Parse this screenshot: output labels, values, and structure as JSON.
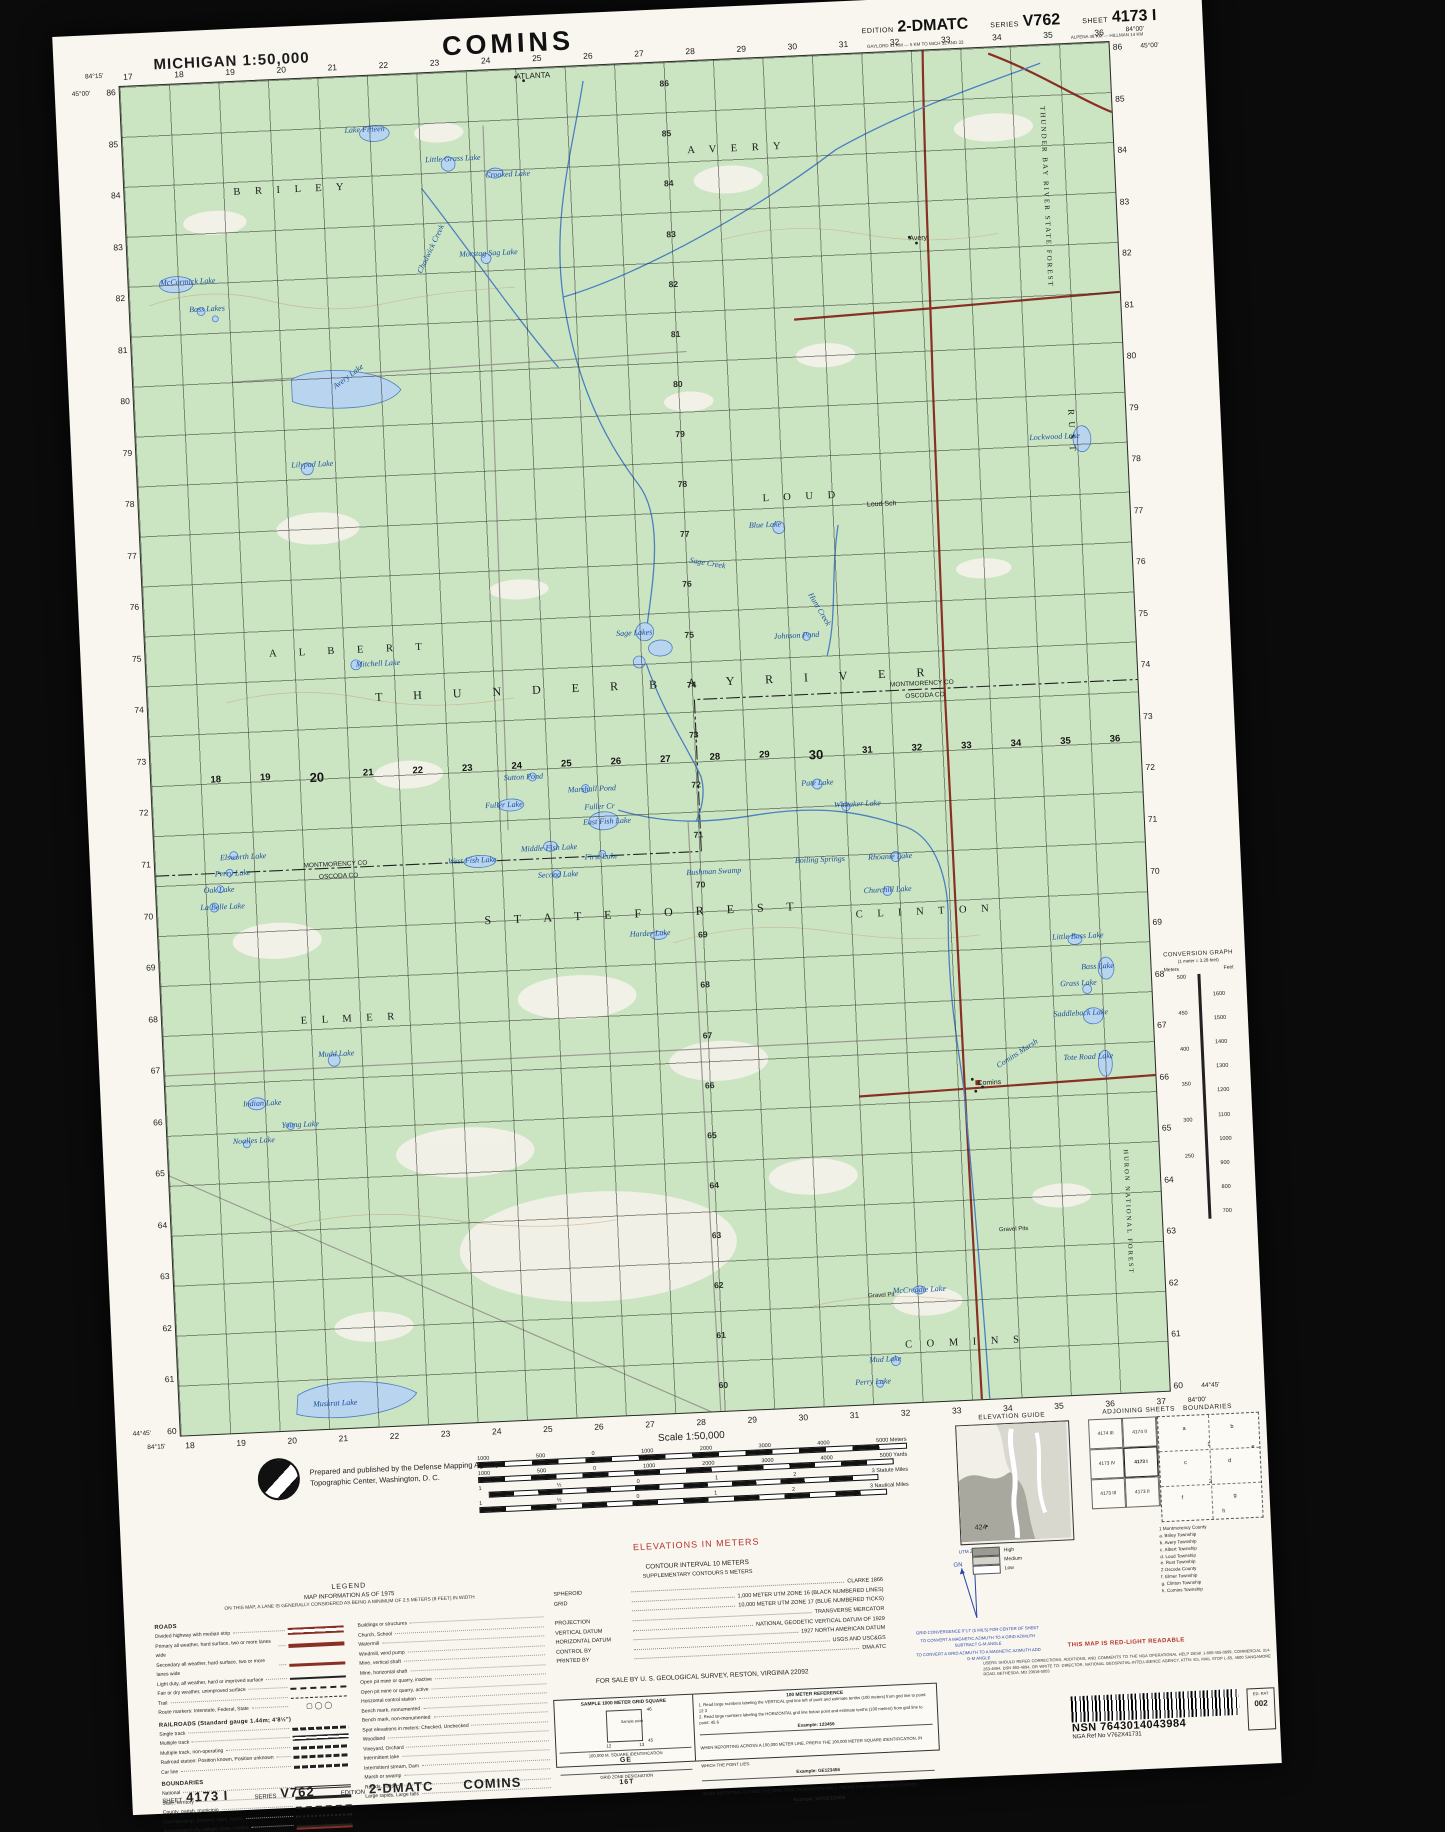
{
  "header": {
    "state_scale": "MICHIGAN 1:50,000",
    "title": "COMINS",
    "edition_label": "EDITION",
    "edition": "2-DMATC",
    "series_label": "SERIES",
    "series": "V762",
    "sheet_label": "SHEET",
    "sheet": "4173 I",
    "note1": "GAYLORD 41 KM — 5 KM TO MICH 32 AND 33",
    "note2": "ALPENA 48 KM — HILLMAN 14 KM"
  },
  "map": {
    "corners": {
      "tl_lon": "84°15'",
      "tr_lon": "84°00'",
      "tl_lat": "45°00'",
      "tr_lat": "45°00'",
      "bl_lat": "44°45'",
      "br_lat": "44°45'",
      "bl_lon": "84°15'",
      "br_lon": "84°00'"
    },
    "top_nums": [
      "17",
      "18",
      "19",
      "20",
      "21",
      "22",
      "23",
      "24",
      "25",
      "26",
      "27",
      "28",
      "29",
      "30",
      "31",
      "32",
      "33",
      "34",
      "35",
      "36"
    ],
    "bottom_nums": [
      "18",
      "19",
      "20",
      "21",
      "22",
      "23",
      "24",
      "25",
      "26",
      "27",
      "28",
      "29",
      "30",
      "31",
      "32",
      "33",
      "34",
      "35",
      "36",
      "37"
    ],
    "left_nums": [
      "86",
      "85",
      "84",
      "83",
      "82",
      "81",
      "80",
      "79",
      "78",
      "77",
      "76",
      "75",
      "74",
      "73",
      "72",
      "71",
      "70",
      "69",
      "68",
      "67",
      "66",
      "65",
      "64",
      "63",
      "62",
      "61",
      "60"
    ],
    "right_nums": [
      "86",
      "85",
      "84",
      "83",
      "82",
      "81",
      "80",
      "79",
      "78",
      "77",
      "76",
      "75",
      "74",
      "73",
      "72",
      "71",
      "70",
      "69",
      "68",
      "67",
      "66",
      "65",
      "64",
      "63",
      "62",
      "61",
      "60"
    ],
    "midrow_nums": [
      "18",
      "19",
      "20",
      "21",
      "22",
      "23",
      "24",
      "25",
      "26",
      "27",
      "28",
      "29",
      "30",
      "31",
      "32",
      "33",
      "34",
      "35",
      "36"
    ],
    "midcol_nums": [
      "86",
      "85",
      "84",
      "83",
      "82",
      "81",
      "80",
      "79",
      "78",
      "77",
      "76",
      "75",
      "74",
      "73",
      "72",
      "71",
      "70",
      "69",
      "68",
      "67",
      "66",
      "65",
      "64",
      "63",
      "62",
      "61",
      "60"
    ],
    "labels": [
      {
        "t": "ATLANTA",
        "x": 40,
        "y": 0.2,
        "c": "p",
        "fs": 8
      },
      {
        "t": "B R I L E Y",
        "x": 11,
        "y": 7.8,
        "c": "t"
      },
      {
        "t": "A V E R Y",
        "x": 57,
        "y": 6.2,
        "c": "t"
      },
      {
        "t": "Lake Fifteen",
        "x": 22.5,
        "y": 3.6,
        "c": "w"
      },
      {
        "t": "Little Grass Lake",
        "x": 30.5,
        "y": 6.1,
        "c": "w"
      },
      {
        "t": "Crooked Lake",
        "x": 36.5,
        "y": 7.4,
        "c": "w"
      },
      {
        "t": "Morstag Sag Lake",
        "x": 33.5,
        "y": 13.2,
        "c": "w"
      },
      {
        "t": "McCormick Lake",
        "x": 3.2,
        "y": 14.3,
        "c": "w"
      },
      {
        "t": "Bass Lakes",
        "x": 6,
        "y": 16.4,
        "c": "w"
      },
      {
        "t": "Chadwick Creek",
        "x": 29,
        "y": 14.6,
        "c": "w",
        "r": -62
      },
      {
        "t": "THUNDER BAY RIVER STATE FOREST",
        "x": 93.4,
        "y": 4.5,
        "c": "tv",
        "r": 90
      },
      {
        "t": "Avery",
        "x": 79,
        "y": 13.6,
        "c": "p"
      },
      {
        "t": "Avery Lake",
        "x": 20,
        "y": 22.7,
        "c": "w",
        "r": -35
      },
      {
        "t": "Lilypad Lake",
        "x": 15.6,
        "y": 28.2,
        "c": "w"
      },
      {
        "t": "Lockwood Lake",
        "x": 90.2,
        "y": 28.7,
        "c": "w"
      },
      {
        "t": "R U S T",
        "x": 95,
        "y": 27,
        "c": "tv",
        "r": 90,
        "fs": 9
      },
      {
        "t": "L O U D",
        "x": 63,
        "y": 32.2,
        "c": "t"
      },
      {
        "t": "Blue Lake",
        "x": 61.5,
        "y": 34.2,
        "c": "w"
      },
      {
        "t": "Loud Sch",
        "x": 73.5,
        "y": 33.2,
        "c": "p"
      },
      {
        "t": "Sage Creek",
        "x": 55.5,
        "y": 36.6,
        "c": "w",
        "r": 12
      },
      {
        "t": "Hunt Creek",
        "x": 67.8,
        "y": 39.6,
        "c": "w",
        "r": 62
      },
      {
        "t": "Sage Lakes",
        "x": 47.6,
        "y": 41.8,
        "c": "w"
      },
      {
        "t": "A L B E R T",
        "x": 12.5,
        "y": 42.1,
        "c": "t",
        "ls": 10
      },
      {
        "t": "Mitchell Lake",
        "x": 21.2,
        "y": 43.2,
        "c": "w"
      },
      {
        "t": "Johnson Pond",
        "x": 63.5,
        "y": 42.5,
        "c": "w"
      },
      {
        "t": "T H U N D E R     B A Y     R I V E R",
        "x": 23,
        "y": 45.5,
        "c": "tb"
      },
      {
        "t": "MONTMORENCY  CO",
        "x": 75,
        "y": 46.6,
        "c": "p",
        "fs": 6.5
      },
      {
        "t": "OSCODA  CO",
        "x": 76.5,
        "y": 47.5,
        "c": "p",
        "fs": 6.5
      },
      {
        "t": "Sutton Pond",
        "x": 35.6,
        "y": 52.1,
        "c": "w"
      },
      {
        "t": "Fuller Lake",
        "x": 33.6,
        "y": 54.1,
        "c": "w"
      },
      {
        "t": "Marshall Pond",
        "x": 42,
        "y": 53.2,
        "c": "w"
      },
      {
        "t": "Fuller Cr",
        "x": 43.6,
        "y": 54.5,
        "c": "w"
      },
      {
        "t": "East Fish Lake",
        "x": 43.4,
        "y": 55.6,
        "c": "w"
      },
      {
        "t": "Middle Fish Lake",
        "x": 37,
        "y": 57.4,
        "c": "w"
      },
      {
        "t": "West Fish Lake",
        "x": 29.6,
        "y": 58.1,
        "c": "w"
      },
      {
        "t": "MONTMORENCY  CO",
        "x": 15,
        "y": 58,
        "c": "p",
        "fs": 6.5
      },
      {
        "t": "OSCODA  CO",
        "x": 16.5,
        "y": 58.9,
        "c": "p",
        "fs": 6.5
      },
      {
        "t": "Bushman Swamp",
        "x": 53.6,
        "y": 59.7,
        "c": "w"
      },
      {
        "t": "Pate Lake",
        "x": 65.6,
        "y": 53.5,
        "c": "w"
      },
      {
        "t": "S T A T E    F O R E S T",
        "x": 33,
        "y": 62.4,
        "c": "tb",
        "ls": 10
      },
      {
        "t": "Harder Lake",
        "x": 47.6,
        "y": 64.1,
        "c": "w"
      },
      {
        "t": "Whitaker Lake",
        "x": 68.8,
        "y": 55.2,
        "c": "w"
      },
      {
        "t": "Elsworth Lake",
        "x": 6.6,
        "y": 57,
        "c": "w"
      },
      {
        "t": "Perry Lake",
        "x": 6,
        "y": 58.2,
        "c": "w"
      },
      {
        "t": "Oak Lake",
        "x": 4.8,
        "y": 59.4,
        "c": "w"
      },
      {
        "t": "La Belle Lake",
        "x": 4.4,
        "y": 60.7,
        "c": "w"
      },
      {
        "t": "First Lake",
        "x": 43.4,
        "y": 58.2,
        "c": "w"
      },
      {
        "t": "Second Lake",
        "x": 38.6,
        "y": 59.4,
        "c": "w"
      },
      {
        "t": "Boiling Springs",
        "x": 64.6,
        "y": 59.2,
        "c": "w"
      },
      {
        "t": "Rhoanie Lake",
        "x": 72,
        "y": 59.2,
        "c": "w"
      },
      {
        "t": "Churchill Lake",
        "x": 71.4,
        "y": 61.6,
        "c": "w"
      },
      {
        "t": "C L I N T O N",
        "x": 70.5,
        "y": 63.3,
        "c": "t"
      },
      {
        "t": "Little Bass Lake",
        "x": 90.2,
        "y": 65.7,
        "c": "w"
      },
      {
        "t": "Bass Lake",
        "x": 93,
        "y": 68,
        "c": "w"
      },
      {
        "t": "Grass Lake",
        "x": 90.8,
        "y": 69.2,
        "c": "w"
      },
      {
        "t": "Saddleback Lake",
        "x": 90,
        "y": 71.4,
        "c": "w"
      },
      {
        "t": "Tote Road Lake",
        "x": 90.8,
        "y": 74.7,
        "c": "w"
      },
      {
        "t": "Comins Marsh",
        "x": 83.8,
        "y": 75.1,
        "c": "w",
        "r": -30
      },
      {
        "t": "Comins",
        "x": 82,
        "y": 76.4,
        "c": "p"
      },
      {
        "t": "E L M E R",
        "x": 14,
        "y": 69.3,
        "c": "t"
      },
      {
        "t": "Mudd Lake",
        "x": 15.6,
        "y": 71.9,
        "c": "w"
      },
      {
        "t": "Indian Lake",
        "x": 7.8,
        "y": 75.3,
        "c": "w"
      },
      {
        "t": "Young Lake",
        "x": 11.6,
        "y": 77,
        "c": "w"
      },
      {
        "t": "Noalles Lake",
        "x": 6.6,
        "y": 78.1,
        "c": "w"
      },
      {
        "t": "Gravel Pits",
        "x": 83.5,
        "y": 87.3,
        "c": "p",
        "fs": 6
      },
      {
        "t": "Gravel Pit",
        "x": 70,
        "y": 91.8,
        "c": "p",
        "fs": 6
      },
      {
        "t": "McCreadie Lake",
        "x": 72.5,
        "y": 91.3,
        "c": "w"
      },
      {
        "t": "C O M I N S",
        "x": 73.5,
        "y": 95.3,
        "c": "t"
      },
      {
        "t": "Mud Lake",
        "x": 69.8,
        "y": 96.4,
        "c": "w"
      },
      {
        "t": "Perry Lake",
        "x": 68.3,
        "y": 98,
        "c": "w"
      },
      {
        "t": "Muskrat Lake",
        "x": 13.5,
        "y": 97.8,
        "c": "w"
      },
      {
        "t": "HURON NATIONAL FOREST",
        "x": 97,
        "y": 82,
        "c": "tv",
        "r": 90,
        "fs": 6.5
      }
    ]
  },
  "convgraph": {
    "title": "CONVERSION GRAPH",
    "sub": "(1 meter = 3.28 feet)",
    "col_meters": "Meters",
    "col_feet": "Feet",
    "meters": [
      "500",
      "450",
      "400",
      "350",
      "300",
      "250"
    ],
    "feet": [
      "1600",
      "1500",
      "1400",
      "1300",
      "1200",
      "1100",
      "1000",
      "900",
      "800",
      "700"
    ]
  },
  "credit": {
    "line1": "Prepared and published by the Defense Mapping Agency",
    "line2": "Topographic Center, Washington, D. C."
  },
  "scale": {
    "label": "Scale 1:50,000",
    "meters": [
      "1000",
      "500",
      "0",
      "1000",
      "2000",
      "3000",
      "4000",
      "5000 Meters"
    ],
    "yards": [
      "1000",
      "500",
      "0",
      "1000",
      "2000",
      "3000",
      "4000",
      "5000 Yards"
    ],
    "statute": [
      "1",
      "½",
      "0",
      "1",
      "2",
      "3 Statute Miles"
    ],
    "nautical": [
      "1",
      "½",
      "0",
      "1",
      "2",
      "3 Nautical Miles"
    ]
  },
  "notes": {
    "elevations": "ELEVATIONS IN METERS",
    "contour": "CONTOUR INTERVAL 10 METERS",
    "supplementary": "SUPPLEMENTARY CONTOURS 5 METERS",
    "for_sale": "FOR SALE BY U. S. GEOLOGICAL SURVEY, RESTON, VIRGINIA 22092",
    "red_light": "THIS MAP IS RED-LIGHT READABLE",
    "corrections": "USERS SHOULD REFER CORRECTIONS, ADDITIONS, AND COMMENTS TO THE NGA OPERATIONAL HELP DESK 1-800-455-0899, COMMERCIAL 314-263-4894, DSN 693-4894, OR WRITE TO: DIRECTOR, NATIONAL GEOSPATIAL-INTELLIGENCE AGENCY, ATTN: ES, MAIL STOP L-65, 4600 SANGAMORE ROAD, BETHESDA, MD 20816-5003"
  },
  "datum_rows": [
    {
      "l": "SPHEROID",
      "v": "CLARKE 1866"
    },
    {
      "l": "GRID",
      "v": "1,000 METER UTM ZONE 16 (BLACK NUMBERED LINES)"
    },
    {
      "l": "",
      "v": "10,000 METER UTM ZONE 17 (BLUE NUMBERED TICKS)"
    },
    {
      "l": "PROJECTION",
      "v": "TRANSVERSE MERCATOR"
    },
    {
      "l": "VERTICAL DATUM",
      "v": "NATIONAL GEODETIC VERTICAL DATUM OF 1929"
    },
    {
      "l": "HORIZONTAL DATUM",
      "v": "1927 NORTH AMERICAN DATUM"
    },
    {
      "l": "CONTROL BY",
      "v": "USGS AND USC&GS"
    },
    {
      "l": "PRINTED BY",
      "v": "DMA ATC"
    }
  ],
  "legend": {
    "title": "LEGEND",
    "subtitle": "MAP INFORMATION AS OF 1975",
    "note": "ON THIS MAP, A LANE IS GENERALLY CONSIDERED AS BEING A MINIMUM OF 2.5 METERS (8 FEET) IN WIDTH",
    "roads_head": "ROADS",
    "roads": [
      {
        "t": "Divided highway with median strip",
        "k": "divided"
      },
      {
        "t": "Primary all weather, hard surface, two or more lanes wide",
        "k": "primary"
      },
      {
        "t": "Secondary all weather, hard surface, two or more lanes wide",
        "k": "secondary"
      },
      {
        "t": "Light duty, all weather, hard or improved surface",
        "k": "light"
      },
      {
        "t": "Fair or dry weather, unimproved surface",
        "k": "fair"
      },
      {
        "t": "Trail",
        "k": "trail"
      },
      {
        "t": "Route markers: Interstate, Federal, State",
        "k": "markers",
        "s": "▢ ◯ ◯"
      }
    ],
    "rail_head": "RAILROADS (Standard gauge 1.44m; 4'8½\")",
    "railroads": [
      {
        "t": "Single track",
        "k": "rail"
      },
      {
        "t": "Multiple track",
        "k": "rail2"
      },
      {
        "t": "Multiple track, non-operating",
        "k": "rail"
      },
      {
        "t": "Railroad station: Position known, Position unknown",
        "k": "rail"
      },
      {
        "t": "Car line",
        "k": "rail"
      }
    ],
    "bound_head": "BOUNDARIES",
    "bounds": [
      {
        "t": "National",
        "k": "bnat"
      },
      {
        "t": "State, territory",
        "k": "bst"
      },
      {
        "t": "County, parish, municipio",
        "k": "bco"
      },
      {
        "t": "Civil township, precinct, town, barrio",
        "k": "btw"
      },
      {
        "t": "Incorporated city, village, town, hamlet",
        "k": "bin"
      },
      {
        "t": "Reservation: National, state, military",
        "k": "bres"
      },
      {
        "t": "Power transmission line",
        "k": "bpow"
      }
    ],
    "right_items": [
      {
        "t": "Buildings or structures"
      },
      {
        "t": "Church, School"
      },
      {
        "t": "Watermill"
      },
      {
        "t": "Windmill, wind pump"
      },
      {
        "t": "Mine, vertical shaft"
      },
      {
        "t": "Mine, horizontal shaft"
      },
      {
        "t": "Open pit mine or quarry, inactive"
      },
      {
        "t": "Open pit mine or quarry, active"
      },
      {
        "t": "Horizontal control station"
      },
      {
        "t": "Bench mark, monumented"
      },
      {
        "t": "Bench mark, non-monumented"
      },
      {
        "t": "Spot elevations in meters: Checked, Unchecked"
      },
      {
        "t": "Woodland"
      },
      {
        "t": "Vineyard, Orchard"
      },
      {
        "t": "Intermittent lake"
      },
      {
        "t": "Intermittent stream, Dam"
      },
      {
        "t": "Marsh or swamp"
      },
      {
        "t": "Rapids, Falls"
      },
      {
        "t": "Large rapids, Large falls"
      }
    ]
  },
  "gridref": {
    "sample_title": "SAMPLE 1000 METER GRID SQUARE",
    "sample_point": "Sample point",
    "n46": "46",
    "n45": "45",
    "n12": "12",
    "n13": "13",
    "sq_label": "100,000 M. SQUARE IDENTIFICATION",
    "sq_id": "GE",
    "zone_label": "GRID ZONE DESIGNATION",
    "zone": "16T",
    "ref_title": "100 METER REFERENCE",
    "step1": "1. Read large numbers labeling the VERTICAL grid line left of point and estimate tenths (100 meters) from grid line to point:  12 3",
    "step2": "2. Read large numbers labeling the HORIZONTAL grid line below point and estimate tenths (100 meters) from grid line to point:  45 6",
    "example1": "Example: 123456",
    "across": "WHEN REPORTING ACROSS A 100,000 METER LINE, PREFIX THE 100,000 METER SQUARE IDENTIFICATION, IN WHICH THE POINT LIES.",
    "example2": "Example: GE123456",
    "outside": "WHEN REPORTING OUTSIDE THE GRID ZONE DESIGNATION AREA, PREFIX THE GRID ZONE DESIGNATION.",
    "example3": "Example: 16TGE123456"
  },
  "declination": {
    "utm": "UTM ZONE 17",
    "gn": "GN",
    "star": "★",
    "convergence": "GRID CONVERGENCE 0°17' (5 MILS) FOR CENTER OF SHEET",
    "note1": "TO CONVERT A MAGNETIC AZIMUTH TO A GRID AZIMUTH SUBTRACT G-M ANGLE",
    "note2": "TO CONVERT A GRID AZIMUTH TO A MAGNETIC AZIMUTH ADD G-M ANGLE"
  },
  "elevguide": {
    "title": "ELEVATION GUIDE",
    "spot": "424",
    "levels": [
      {
        "t": "High",
        "k": "high"
      },
      {
        "t": "Medium",
        "k": "med"
      },
      {
        "t": "Low",
        "k": "low"
      }
    ]
  },
  "adjoining": {
    "title": "ADJOINING SHEETS",
    "cells": [
      "4174 III",
      "4174 II",
      "4274 III",
      "4173 IV",
      "4173 I",
      "4273 IV",
      "4173 III",
      "4173 II",
      "4273 III"
    ]
  },
  "boundaries_panel": {
    "title": "BOUNDARIES",
    "letters": [
      {
        "t": "a",
        "x": 24,
        "y": 10
      },
      {
        "t": "b",
        "x": 72,
        "y": 10
      },
      {
        "t": "c",
        "x": 24,
        "y": 42
      },
      {
        "t": "d",
        "x": 68,
        "y": 42
      },
      {
        "t": "e",
        "x": 92,
        "y": 30
      },
      {
        "t": "1",
        "x": 48,
        "y": 26
      },
      {
        "t": "2",
        "x": 48,
        "y": 62
      },
      {
        "t": "f",
        "x": 20,
        "y": 76
      },
      {
        "t": "g",
        "x": 72,
        "y": 76
      },
      {
        "t": "h",
        "x": 60,
        "y": 90
      }
    ],
    "list": [
      {
        "t": "1  Montmorency County"
      },
      {
        "t": "    a. Briley Township"
      },
      {
        "t": "    b. Avery Township"
      },
      {
        "t": "    c. Albert Township"
      },
      {
        "t": "    d. Loud Township"
      },
      {
        "t": "    e. Rust Township"
      },
      {
        "t": "2  Oscoda County"
      },
      {
        "t": "    f. Elmer Township"
      },
      {
        "t": "    g. Clinton Township"
      },
      {
        "t": "    h. Comins Township"
      }
    ]
  },
  "nsn": {
    "nsn_label": "NSN",
    "nsn": "7643014043984",
    "ref_label": "NGA Ref No",
    "ref": "V762X41731",
    "ed_label": "ED. RAT",
    "ed": "002"
  },
  "footer": {
    "sheet_label": "SHEET",
    "sheet": "4173 I",
    "series_label": "SERIES",
    "series": "V762",
    "edition_label": "EDITION",
    "edition": "2-DMATC",
    "title": "COMINS"
  },
  "colors": {
    "map_green": "#cbe5c2",
    "water_blue": "#b9d4ef",
    "water_line": "#4a7fc1",
    "road_red": "#8a2f23",
    "red_note": "#b5342a",
    "declination_blue": "#2a47a8"
  }
}
